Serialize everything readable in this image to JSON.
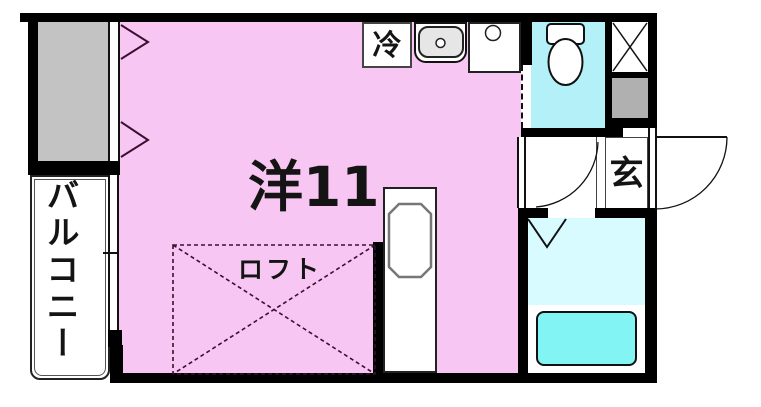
{
  "type": "apartment-floor-plan",
  "rooms": {
    "main_room": {
      "label": "洋11",
      "description": "western-style-room-11-mats"
    },
    "loft": {
      "label": "ロフト"
    },
    "balcony": {
      "label": "バルコニー"
    },
    "kitchen": {
      "refrigerator_label": "冷"
    },
    "entrance": {
      "label": "玄"
    }
  },
  "fixtures": [
    "closet",
    "closet-door-arrows",
    "balcony-window",
    "refrigerator",
    "kitchen-sink",
    "stove-burner",
    "toilet",
    "pipe-shaft-x",
    "meter-box",
    "entrance-door-arc",
    "corridor-door-arc",
    "sliding-door",
    "bathroom-door-v",
    "bathtub",
    "washing-machine-pan"
  ],
  "colors": {
    "wall": "#000000",
    "main_room_fill": "#f8c6f2",
    "toilet_fill": "#b4f0f8",
    "bathroom_fill": "#d8fbff",
    "bathtub_fill": "#83f4f4",
    "closet_fill": "#c3c3c3",
    "shaft_fill": "#b0b0b0",
    "sink_fill": "#e6e6e6",
    "accent_line": "#3a1030"
  }
}
